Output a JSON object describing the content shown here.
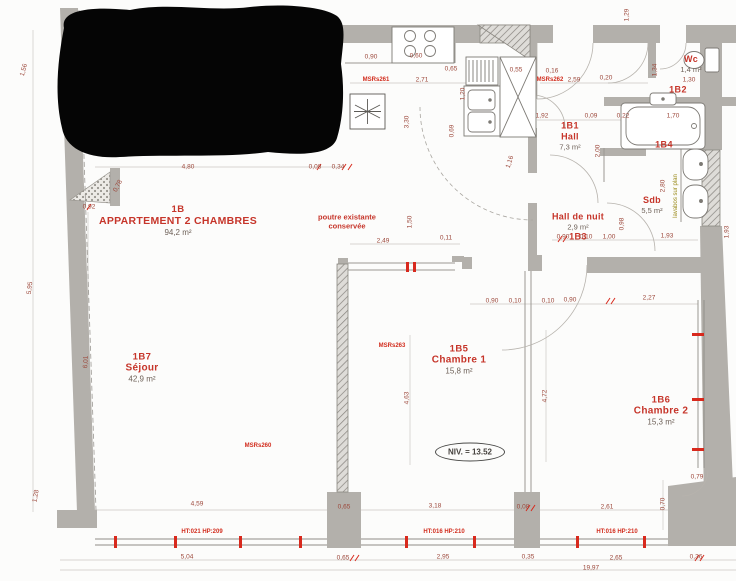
{
  "plan_title": "1B APPARTEMENT 2 CHAMBRES",
  "colors": {
    "label_red": "#c6352a",
    "dim_red": "#9c473a",
    "ref_red": "#d22d1e",
    "tick_red": "#d8291d",
    "area_gray": "#6e6158",
    "wall_gray": "#b3b0ab",
    "note_olive": "#9a8a1a",
    "redaction_black": "#050505"
  },
  "rooms": [
    {
      "lines": [
        "1B",
        "APPARTEMENT 2 CHAMBRES",
        "94,2 m²"
      ],
      "x": 178,
      "y": 221,
      "cls": "lg"
    },
    {
      "lines": [
        "1B7",
        "Séjour",
        "42,9 m²"
      ],
      "x": 142,
      "y": 368,
      "cls": "md"
    },
    {
      "lines": [
        "1B5",
        "Chambre 1",
        "15,8 m²"
      ],
      "x": 459,
      "y": 360,
      "cls": "md"
    },
    {
      "lines": [
        "1B6",
        "Chambre 2",
        "15,3 m²"
      ],
      "x": 661,
      "y": 411,
      "cls": "md"
    },
    {
      "lines": [
        "1B1",
        "Hall",
        "7,3 m²"
      ],
      "x": 570,
      "y": 136,
      "cls": "sm"
    },
    {
      "lines": [
        "Hall de nuit",
        "2,9 m²",
        "1B3"
      ],
      "x": 578,
      "y": 227,
      "cls": "sm"
    },
    {
      "lines": [
        "Sdb",
        "5,5 m²"
      ],
      "x": 652,
      "y": 205,
      "cls": "sm"
    },
    {
      "lines": [
        "Wc",
        "1,4 m²"
      ],
      "x": 691,
      "y": 64,
      "cls": "sm"
    },
    {
      "lines": [
        "1B2"
      ],
      "x": 678,
      "y": 90,
      "cls": "sm"
    },
    {
      "lines": [
        "1B4"
      ],
      "x": 664,
      "y": 145,
      "cls": "sm"
    }
  ],
  "notes": {
    "poutre_line1": "poutre existante",
    "poutre_line2": "conservée",
    "niv": "NIV. = 13.52",
    "lavabos": "lavabos sur plan"
  },
  "refs": [
    {
      "t": "MSRs261",
      "x": 376,
      "y": 80
    },
    {
      "t": "MSRs262",
      "x": 550,
      "y": 80
    },
    {
      "t": "MSRs263",
      "x": 392,
      "y": 346
    },
    {
      "t": "MSRs260",
      "x": 258,
      "y": 446
    },
    {
      "t": "HT:021 HP:209",
      "x": 202,
      "y": 532
    },
    {
      "t": "HT:016 HP:210",
      "x": 444,
      "y": 532
    },
    {
      "t": "HT:016 HP:210",
      "x": 617,
      "y": 532
    }
  ],
  "dims": [
    {
      "t": "4,80",
      "x": 188,
      "y": 167
    },
    {
      "t": "0,08",
      "x": 315,
      "y": 167
    },
    {
      "t": "0,34",
      "x": 338,
      "y": 167
    },
    {
      "t": "0,92",
      "x": 89,
      "y": 207
    },
    {
      "t": "0,78",
      "x": 118,
      "y": 186,
      "r": -62
    },
    {
      "t": "1,56",
      "x": 24,
      "y": 70,
      "r": -75
    },
    {
      "t": "5,95",
      "x": 30,
      "y": 288,
      "r": -83
    },
    {
      "t": "6,01",
      "x": 86,
      "y": 362,
      "r": -87
    },
    {
      "t": "1,28",
      "x": 36,
      "y": 496,
      "r": -80
    },
    {
      "t": "0,90",
      "x": 371,
      "y": 57
    },
    {
      "t": "0,60",
      "x": 416,
      "y": 56
    },
    {
      "t": "0,65",
      "x": 451,
      "y": 69
    },
    {
      "t": "0,55",
      "x": 516,
      "y": 70
    },
    {
      "t": "2,71",
      "x": 422,
      "y": 80
    },
    {
      "t": "3,30",
      "x": 407,
      "y": 122,
      "r": -90
    },
    {
      "t": "1,20",
      "x": 463,
      "y": 94,
      "r": -90
    },
    {
      "t": "0,69",
      "x": 452,
      "y": 131,
      "r": -90
    },
    {
      "t": "1,16",
      "x": 510,
      "y": 162,
      "r": -72
    },
    {
      "t": "2,49",
      "x": 383,
      "y": 241
    },
    {
      "t": "0,11",
      "x": 446,
      "y": 238
    },
    {
      "t": "1,50",
      "x": 410,
      "y": 222,
      "r": -90
    },
    {
      "t": "2,59",
      "x": 574,
      "y": 80
    },
    {
      "t": "0,16",
      "x": 552,
      "y": 71
    },
    {
      "t": "0,20",
      "x": 606,
      "y": 78
    },
    {
      "t": "1,92",
      "x": 542,
      "y": 116
    },
    {
      "t": "0,09",
      "x": 591,
      "y": 116
    },
    {
      "t": "0,22",
      "x": 623,
      "y": 116
    },
    {
      "t": "1,34",
      "x": 655,
      "y": 70,
      "r": -90
    },
    {
      "t": "1,30",
      "x": 689,
      "y": 80
    },
    {
      "t": "1,70",
      "x": 673,
      "y": 116
    },
    {
      "t": "2,00",
      "x": 598,
      "y": 151,
      "r": -90
    },
    {
      "t": "2,80",
      "x": 663,
      "y": 186,
      "r": -90
    },
    {
      "t": "0,98",
      "x": 622,
      "y": 224,
      "r": -90
    },
    {
      "t": "1,93",
      "x": 667,
      "y": 236
    },
    {
      "t": "1,93",
      "x": 727,
      "y": 232,
      "r": -90
    },
    {
      "t": "0,90",
      "x": 563,
      "y": 237
    },
    {
      "t": "0,10",
      "x": 586,
      "y": 237
    },
    {
      "t": "1,00",
      "x": 609,
      "y": 237
    },
    {
      "t": "0,90",
      "x": 492,
      "y": 301
    },
    {
      "t": "0,10",
      "x": 515,
      "y": 301
    },
    {
      "t": "0,10",
      "x": 548,
      "y": 301
    },
    {
      "t": "0,90",
      "x": 570,
      "y": 300
    },
    {
      "t": "2,27",
      "x": 649,
      "y": 298
    },
    {
      "t": "4,63",
      "x": 407,
      "y": 398,
      "r": -90
    },
    {
      "t": "4,72",
      "x": 545,
      "y": 396,
      "r": -90
    },
    {
      "t": "0,79",
      "x": 697,
      "y": 477
    },
    {
      "t": "0,70",
      "x": 663,
      "y": 504,
      "r": -90
    },
    {
      "t": "4,59",
      "x": 197,
      "y": 504
    },
    {
      "t": "3,18",
      "x": 435,
      "y": 506
    },
    {
      "t": "0,08",
      "x": 523,
      "y": 507
    },
    {
      "t": "2,61",
      "x": 607,
      "y": 507
    },
    {
      "t": "0,65",
      "x": 344,
      "y": 507
    },
    {
      "t": "5,04",
      "x": 187,
      "y": 557
    },
    {
      "t": "0,65",
      "x": 343,
      "y": 558
    },
    {
      "t": "2,95",
      "x": 443,
      "y": 557
    },
    {
      "t": "0,35",
      "x": 528,
      "y": 557
    },
    {
      "t": "2,65",
      "x": 616,
      "y": 558
    },
    {
      "t": "0,36",
      "x": 696,
      "y": 557
    },
    {
      "t": "19,97",
      "x": 591,
      "y": 568
    },
    {
      "t": "1,29",
      "x": 627,
      "y": 15,
      "r": -90
    }
  ]
}
